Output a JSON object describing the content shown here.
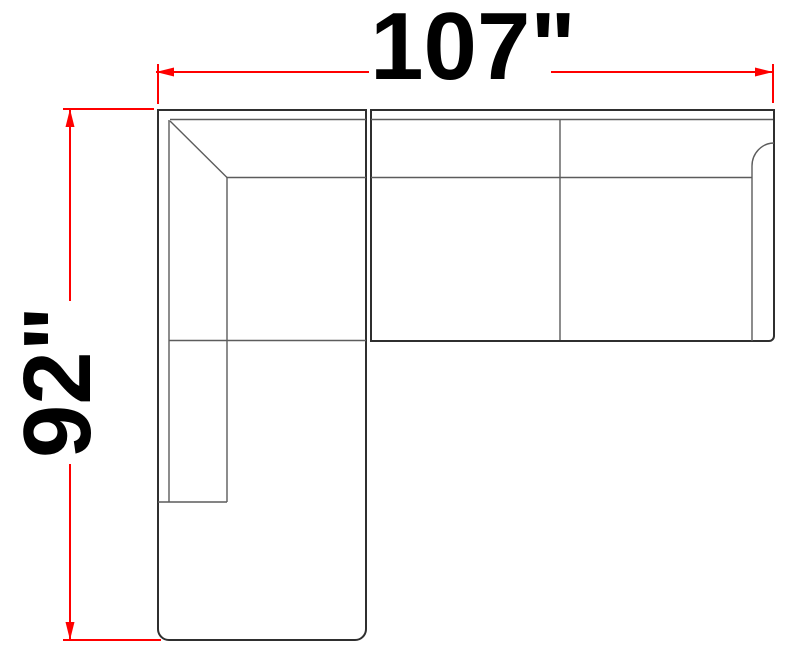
{
  "diagram": {
    "dimensions": {
      "width": {
        "label": "107\"",
        "inches": 107,
        "orientation": "horizontal"
      },
      "height": {
        "label": "92\"",
        "inches": 92,
        "orientation": "vertical"
      }
    },
    "colors": {
      "dimension_lines": "#ff0000",
      "outline": "#2f2f2f",
      "seams": "#5c5c5c",
      "label_text": "#000000",
      "background": "#ffffff"
    }
  }
}
